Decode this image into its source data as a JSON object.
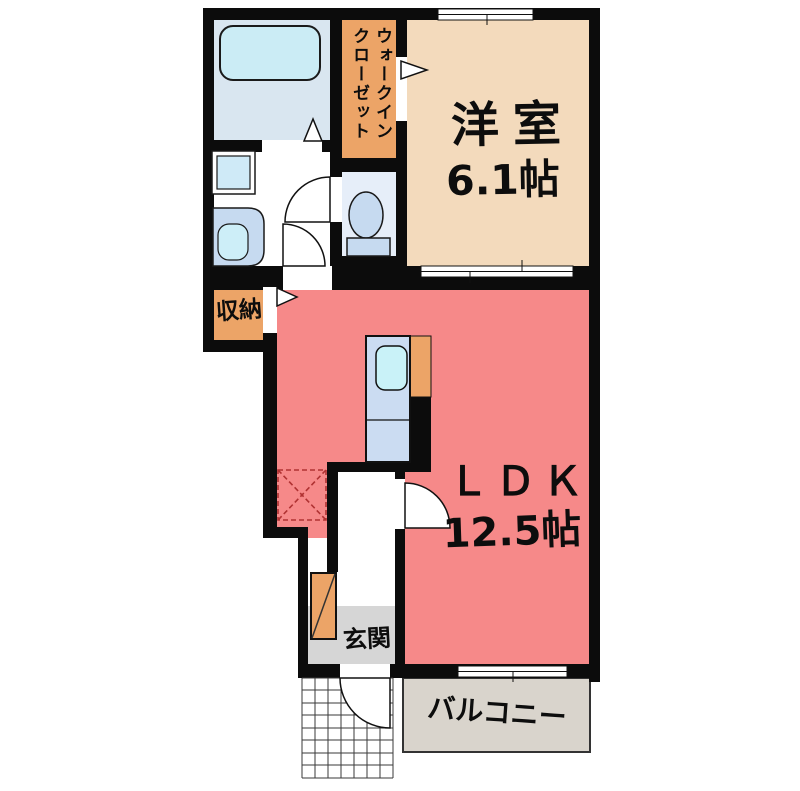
{
  "floorplan": {
    "rooms": {
      "western_room": {
        "label": "洋室",
        "area": "6.1帖"
      },
      "ldk": {
        "label": "ＬＤＫ",
        "area": "12.5帖"
      },
      "walk_in_closet": {
        "column1": "ウォークイン",
        "column2": "クローゼット"
      },
      "storage": {
        "label": "収納"
      },
      "entrance": {
        "label": "玄関"
      },
      "balcony": {
        "label": "バルコニー"
      }
    },
    "colors": {
      "wall": "#0c0c0c",
      "ldk_fill": "#f68989",
      "western_room_fill": "#f3dabc",
      "closet_orange": "#eca467",
      "bathroom_fill": "#d9e6f0",
      "fixture_blue": "#c6daf0",
      "water_cyan": "#c9f2f8",
      "kitchen_counter_blue": "#cbdcf2",
      "balcony_fill": "#d9d4cc",
      "entrance_floor_gray": "#d6d6d6",
      "refrigerator_dash_red": "#b03232"
    }
  }
}
